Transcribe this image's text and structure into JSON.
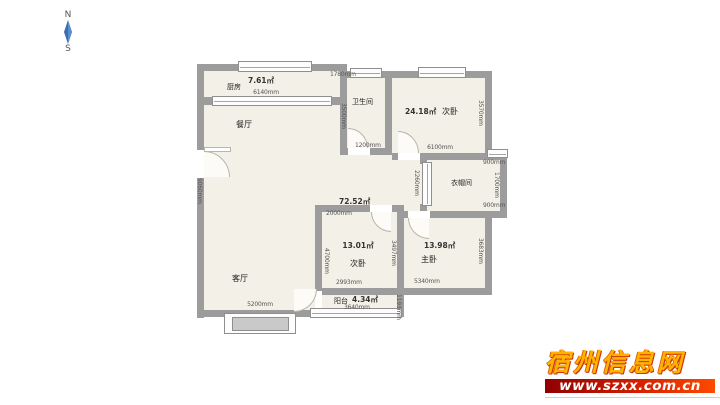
{
  "compass": {
    "north": "N",
    "south": "S"
  },
  "watermark": {
    "site_name": "宿州信息网",
    "url": "www.szxx.com.cn"
  },
  "plan": {
    "kitchen": {
      "name": "厨房",
      "area": "7.61㎡",
      "dim_width": "6140mm"
    },
    "dining": {
      "name": "餐厅"
    },
    "living": {
      "name": "客厅",
      "dim_width": "5200mm"
    },
    "hall": {
      "area": "72.52㎡",
      "dim": "2000mm"
    },
    "bathroom": {
      "name": "卫生间",
      "dim_left": "3500mm",
      "dim_top": "1780mm",
      "dim_bottom": "1200mm"
    },
    "bedroom_top": {
      "name": "次卧",
      "area": "24.18㎡",
      "dim_bottom": "6100mm",
      "dim_right": "3570mm"
    },
    "cloakroom": {
      "name": "衣帽间",
      "dim_top": "900mm",
      "dim_right": "1700mm",
      "dim_bottom": "900mm",
      "dim_left": "2260mm"
    },
    "bedroom_mid": {
      "name": "次卧",
      "area": "13.01㎡",
      "dim_left": "4700mm",
      "dim_bottom": "2993mm",
      "dim_right": "3497mm"
    },
    "master": {
      "name": "主卧",
      "area": "13.98㎡",
      "dim_bottom": "5340mm",
      "dim_right": "3683mm"
    },
    "balcony": {
      "name": "阳台",
      "area": "4.34㎡",
      "dim_bottom": "3640mm",
      "dim_right": "1193mm"
    },
    "outer": {
      "dim_left": "9060mm"
    }
  },
  "colors": {
    "wall": "#9c9c9c",
    "floor": "#f3f0e7",
    "compass_blue": "#3a6db5",
    "watermark_yellow": "#ffb300",
    "watermark_bar": "#d42000"
  }
}
